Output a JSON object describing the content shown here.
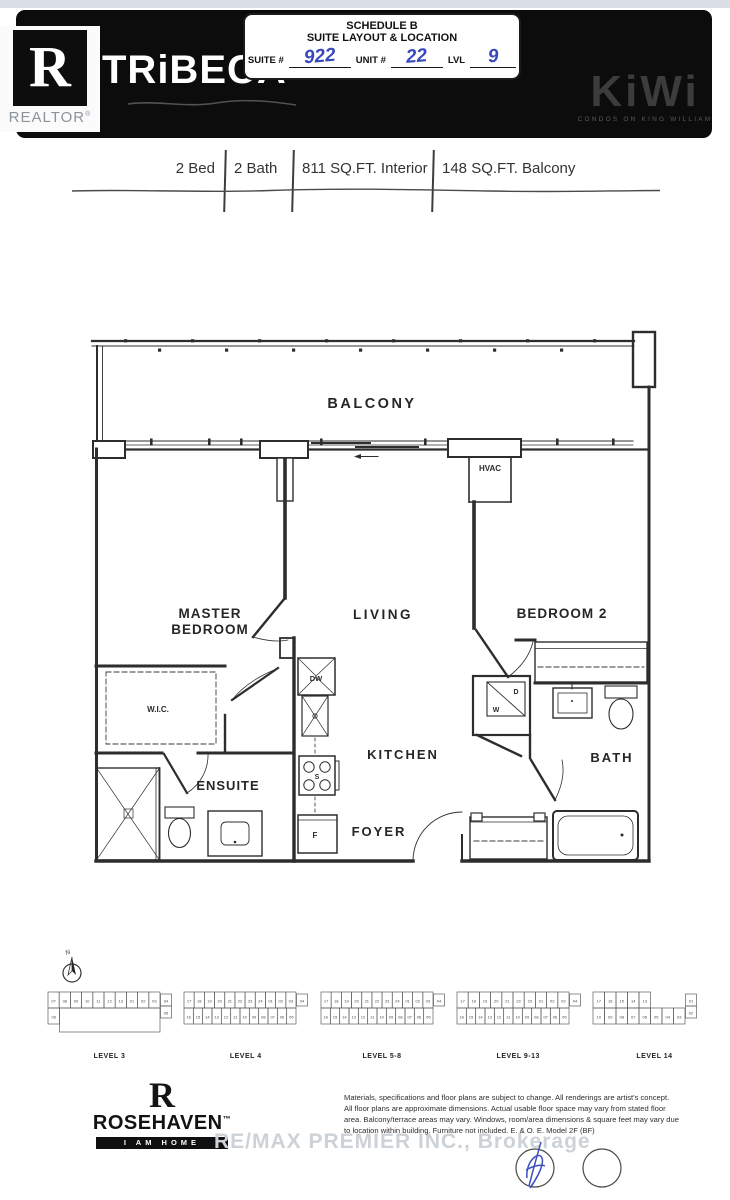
{
  "header": {
    "realtor": {
      "letter": "R",
      "label": "REALTOR",
      "reg": "®"
    },
    "brand": "TRiBECA",
    "schedule": {
      "line1": "SCHEDULE B",
      "line2": "SUITE LAYOUT & LOCATION",
      "suite_label": "SUITE #",
      "suite_value": "922",
      "unit_label": "UNIT #",
      "unit_value": "22",
      "lvl_label": "LVL",
      "lvl_value": "9"
    },
    "kiwi": {
      "name": "KiWi",
      "tagline": "CONDOS ON KING WILLIAM"
    }
  },
  "specs": {
    "items": [
      "2 Bed",
      "2 Bath",
      "811 SQ.FT. Interior",
      "148 SQ.FT. Balcony"
    ]
  },
  "floorplan": {
    "labels": {
      "balcony": "BALCONY",
      "hvac": "HVAC",
      "master1": "MASTER",
      "master2": "BEDROOM",
      "living": "LIVING",
      "bedroom2": "BEDROOM 2",
      "wic": "W.I.C.",
      "ensuite": "ENSUITE",
      "kitchen": "KITCHEN",
      "foyer": "FOYER",
      "bath": "BATH",
      "dishwasher": "DW",
      "stove": "S",
      "fridge": "F",
      "dryer": "D",
      "washer": "W"
    }
  },
  "levels": {
    "compass": "N",
    "maps": [
      {
        "label": "LEVEL 3",
        "top": [
          "07",
          "08",
          "09",
          "10",
          "11",
          "12",
          "13",
          "01",
          "02",
          "03"
        ],
        "bottom": [
          "06"
        ],
        "right": [
          "04",
          "05"
        ],
        "open": true
      },
      {
        "label": "LEVEL 4",
        "top": [
          "17",
          "18",
          "19",
          "20",
          "21",
          "22",
          "23",
          "24",
          "01",
          "02",
          "03"
        ],
        "bottom": [
          "16",
          "15",
          "14",
          "13",
          "12",
          "11",
          "10",
          "09",
          "08",
          "07",
          "06",
          "05"
        ],
        "right": [
          "04"
        ],
        "open": false
      },
      {
        "label": "LEVEL 5-8",
        "top": [
          "17",
          "18",
          "19",
          "20",
          "21",
          "22",
          "23",
          "24",
          "01",
          "02",
          "03"
        ],
        "bottom": [
          "16",
          "15",
          "14",
          "13",
          "12",
          "11",
          "10",
          "09",
          "08",
          "07",
          "06",
          "05"
        ],
        "right": [
          "04"
        ],
        "open": false
      },
      {
        "label": "LEVEL 9-13",
        "top": [
          "17",
          "18",
          "19",
          "20",
          "21",
          "22",
          "23",
          "01",
          "02",
          "03"
        ],
        "bottom": [
          "16",
          "15",
          "14",
          "13",
          "12",
          "11",
          "10",
          "09",
          "08",
          "07",
          "06",
          "05"
        ],
        "right": [
          "04"
        ],
        "open": false
      },
      {
        "label": "LEVEL 14",
        "top": [
          "17",
          "16",
          "15",
          "14",
          "13"
        ],
        "bottom": [
          "10",
          "09",
          "08",
          "07",
          "06",
          "05",
          "04",
          "03"
        ],
        "right": [
          "01",
          "02"
        ],
        "open": false
      }
    ]
  },
  "footer": {
    "rosehaven": {
      "letter": "R",
      "name": "ROSEHAVEN",
      "tm": "™",
      "tagline": "I AM HOME"
    },
    "watermark": "RE/MAX PREMIER INC., Brokerage",
    "disclaimer": [
      "Materials, specifications and floor plans are subject to change. All renderings are artist's concept.",
      "All floor plans are approximate dimensions. Actual usable floor space may vary from stated floor",
      "area. Balcony/terrace areas may vary. Windows, room/area dimensions & square feet may vary due",
      "to location within building. Furniture not included. E. & O. E. Model 2F (BF)"
    ]
  }
}
